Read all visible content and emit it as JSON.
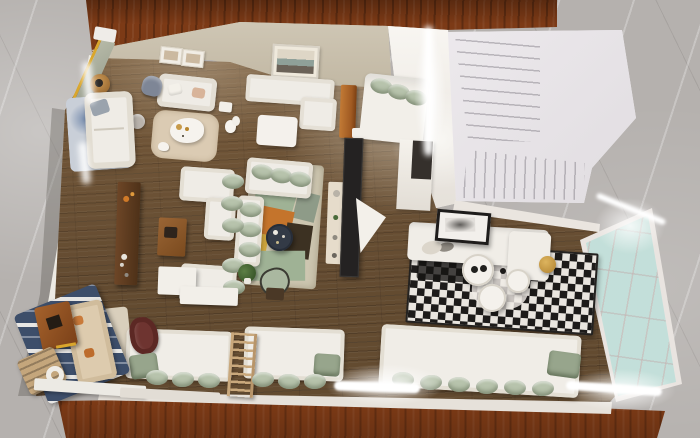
{
  "scene": {
    "description": "Photorealistic 3D render: top-down dollhouse view of a furnished open-plan apartment model standing on a dark wooden table over a gray marble floor",
    "areas": [
      "top-left lounge bedroom with framed prints and marble partition",
      "left reading corner with sofa on blue watercolor rug",
      "upper nook with landscape painting, L-bench and bed",
      "white switchback staircase",
      "central living room with white sectional, sage cushions and geometric rug",
      "right lounge with pixel-pattern rug, round tables and glass panel wall",
      "bottom bench seating row with sage pillows",
      "bottom-left reading nook with striped rug"
    ],
    "objects": [
      "marble-partition-wall",
      "framed-prints",
      "loveseat-sofa",
      "butterfly-chair",
      "round-wood-side-tables",
      "white-dog-statue",
      "blue-watercolor-rug",
      "left-lounge-sofa",
      "gray-ottoman",
      "beige-round-rug",
      "white-organic-coffee-table",
      "duck-figurine",
      "landscape-painting",
      "l-shaped-bench-sofa",
      "white-ottoman-table",
      "orange-wood-cabinet",
      "white-bed-with-sage-pillows",
      "white-staircase",
      "dark-wood-console",
      "wood-coffee-table",
      "white-sectional-sofa",
      "sage-cushions",
      "geometric-area-rug",
      "navy-round-coffee-table",
      "sage-accent-chair",
      "potted-plant",
      "tv-panel",
      "cream-shelf-unit",
      "white-partition-wall",
      "leaning-framed-art",
      "right-room-sofa-with-chaise",
      "pixel-pattern-rug",
      "white-round-nesting-tables",
      "brass-side-table",
      "glass-panel-wall",
      "led-light-strips",
      "bench-seating-with-sage-pillows",
      "wooden-ladder",
      "maroon-armchair",
      "navy-striped-rug",
      "tan-nook-sofa",
      "wood-square-table",
      "tan-lounge-chair",
      "white-ring-decor",
      "white-ledge-boards"
    ]
  },
  "palette": {
    "marble_floor": "#b5b1ae",
    "table_wood": "#7c3a16",
    "floor_wood": "#6e5336",
    "floor_wood_light": "#97764e",
    "wall_beige": "#c9c0ae",
    "wall_white": "#eceae3",
    "sofa_white": "#efece6",
    "cushion_sage": "#b7c3ac",
    "cushion_sage_dark": "#97a58c",
    "stair_white": "#eeeaee",
    "glass_mint": "#cfe7e1",
    "rug_blue": "#c9cfd8",
    "rug_round_beige": "#dbcbb3",
    "rug_geo_base": "#cdc6b0",
    "rug_geo_green": "#9fb295",
    "rug_geo_orange": "#c4742c",
    "rug_geo_brown": "#3c3122",
    "rug_geo_yellow": "#d2a93e",
    "rug_pixel_dark": "#1d1b1a",
    "rug_pixel_light": "#e9e5df",
    "table_navy": "#333a46",
    "console_wood": "#4e3118",
    "coffee_table_wood": "#8a5a2e",
    "chair_maroon": "#6e3430",
    "ladder_wood": "#c9a87c",
    "rug_stripe_navy": "#3d4e6a",
    "sofa_tan": "#ddcbae",
    "accent_gold": "#c79a4a",
    "partition_marble": "#a9ab9d",
    "partition_trim_yellow": "#d9a62c",
    "led_white": "#ffffff"
  }
}
